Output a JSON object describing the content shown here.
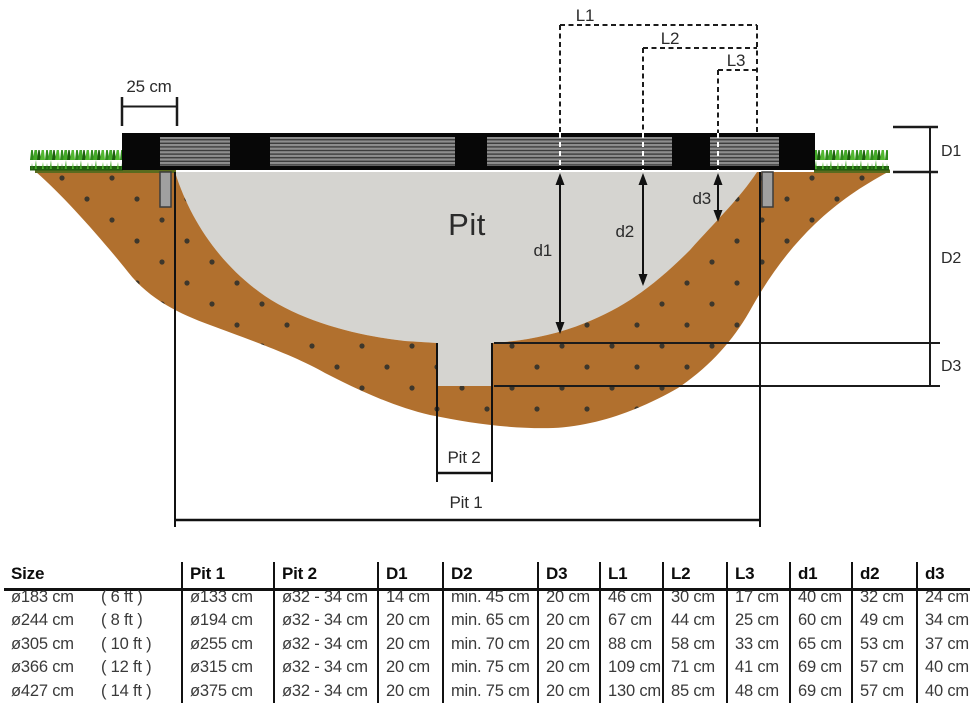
{
  "diagram": {
    "labels": {
      "offset": "25 cm",
      "l1": "L1",
      "l2": "L2",
      "l3": "L3",
      "cap_d1": "D1",
      "cap_d2": "D2",
      "cap_d3": "D3",
      "small_d1": "d1",
      "small_d2": "d2",
      "small_d3": "d3",
      "pit": "Pit",
      "pit1": "Pit 1",
      "pit2": "Pit 2"
    },
    "colors": {
      "soil": "#b1702e",
      "pit_fill": "#d5d4d0",
      "frame": "#070707",
      "dim_line": "#1b1b1b",
      "grass_base": "#1e5c10",
      "soil_top_line": "#5a6b1e",
      "leg": "#a0a0a0"
    }
  },
  "table": {
    "headers": [
      "Size",
      "Pit 1",
      "Pit 2",
      "D1",
      "D2",
      "D3",
      "L1",
      "L2",
      "L3",
      "d1",
      "d2",
      "d3"
    ],
    "rows": [
      {
        "size": "ø183 cm",
        "ft": "( 6 ft )",
        "pit1": "ø133 cm",
        "pit2": "ø32 - 34 cm",
        "D1": "14 cm",
        "D2": "min. 45 cm",
        "D3": "20 cm",
        "L1": "46 cm",
        "L2": "30 cm",
        "L3": "17 cm",
        "d1": "40 cm",
        "d2": "32 cm",
        "d3": "24 cm"
      },
      {
        "size": "ø244 cm",
        "ft": "( 8 ft )",
        "pit1": "ø194 cm",
        "pit2": "ø32 - 34 cm",
        "D1": "20 cm",
        "D2": "min. 65 cm",
        "D3": "20 cm",
        "L1": "67 cm",
        "L2": "44 cm",
        "L3": "25 cm",
        "d1": "60 cm",
        "d2": "49 cm",
        "d3": "34 cm"
      },
      {
        "size": "ø305 cm",
        "ft": "( 10 ft )",
        "pit1": "ø255 cm",
        "pit2": "ø32 - 34 cm",
        "D1": "20 cm",
        "D2": "min. 70 cm",
        "D3": "20 cm",
        "L1": "88 cm",
        "L2": "58 cm",
        "L3": "33 cm",
        "d1": "65 cm",
        "d2": "53 cm",
        "d3": "37 cm"
      },
      {
        "size": "ø366 cm",
        "ft": "( 12 ft )",
        "pit1": "ø315 cm",
        "pit2": "ø32 - 34 cm",
        "D1": "20 cm",
        "D2": "min. 75 cm",
        "D3": "20 cm",
        "L1": "109 cm",
        "L2": "71 cm",
        "L3": "41 cm",
        "d1": "69 cm",
        "d2": "57 cm",
        "d3": "40 cm"
      },
      {
        "size": "ø427 cm",
        "ft": "( 14 ft )",
        "pit1": "ø375 cm",
        "pit2": "ø32 - 34 cm",
        "D1": "20 cm",
        "D2": "min. 75 cm",
        "D3": "20 cm",
        "L1": "130 cm",
        "L2": "85 cm",
        "L3": "48 cm",
        "d1": "69 cm",
        "d2": "57 cm",
        "d3": "40 cm"
      }
    ]
  }
}
